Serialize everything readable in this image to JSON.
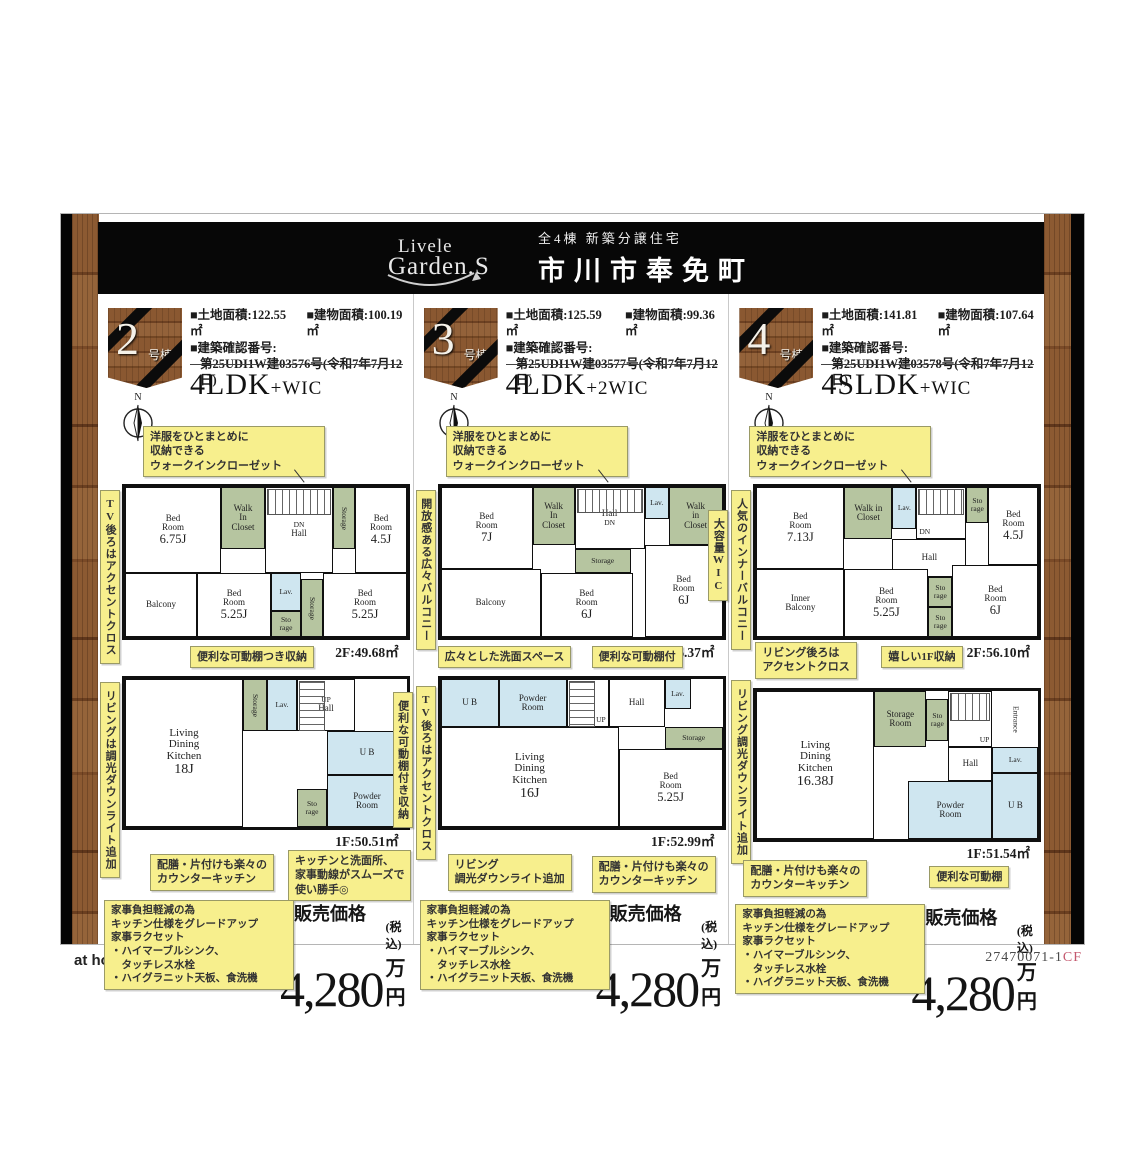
{
  "header": {
    "logo_top": "Livele",
    "logo_bottom": "Garden.S",
    "subtitle": "全4棟 新築分譲住宅",
    "title": "市川市奉免町"
  },
  "compass": {
    "north": "N"
  },
  "footer": {
    "brand": "at home",
    "code": "27470071-1",
    "code_suffix": "CF"
  },
  "panels": [
    {
      "badge": {
        "number": "2",
        "suffix": "号棟"
      },
      "specs": {
        "land": "■土地面積:122.55㎡",
        "building": "■建物面積:100.19㎡",
        "confirm_label": "■建築確認番号:",
        "confirm_value": "第25UDI1W建03576号(令和7年7月12日)"
      },
      "layout_main": "4LDK",
      "layout_sub": "+WIC",
      "notes": {
        "wic": "洋服をひとまとめに\n収納できる\nウォークインクローゼット",
        "left2f": "TV後ろはアクセントクロス",
        "mid": "便利な可動棚つき収納",
        "left1f": "リビングは調光ダウンライト追加",
        "right1f": "便利な可動棚付き収納",
        "bottom1": "配膳・片付けも楽々の\nカウンターキッチン",
        "bottom2": "キッチンと洗面所、\n家事動線がスムーズで\n使い勝手◎"
      },
      "plan2f": {
        "area": "2F:49.68㎡",
        "rooms": {
          "bed1": {
            "label": "Bed\nRoom",
            "size": "6.75J"
          },
          "wic": {
            "label": "Walk\nIn\nCloset"
          },
          "dn": {
            "label": "DN"
          },
          "hall": {
            "label": "Hall"
          },
          "storage1": {
            "label": "Storage"
          },
          "bed2": {
            "label": "Bed\nRoom",
            "size": "4.5J"
          },
          "balcony": {
            "label": "Balcony"
          },
          "bed3": {
            "label": "Bed\nRoom",
            "size": "5.25J"
          },
          "lav": {
            "label": "Lav."
          },
          "sto": {
            "label": "Sto\nrage"
          },
          "storage2": {
            "label": "Storage"
          },
          "bed4": {
            "label": "Bed\nRoom",
            "size": "5.25J"
          }
        }
      },
      "plan1f": {
        "area": "1F:50.51㎡",
        "rooms": {
          "ldk": {
            "label": "Living\nDining\nKitchen",
            "size": "18J"
          },
          "storage": {
            "label": "Storage"
          },
          "lav": {
            "label": "Lav."
          },
          "up": {
            "label": "UP"
          },
          "hall": {
            "label": "Hall"
          },
          "ub": {
            "label": "U B"
          },
          "powder": {
            "label": "Powder\nRoom"
          },
          "sto": {
            "label": "Sto\nrage"
          }
        }
      },
      "price": {
        "features": "家事負担軽減の為\nキッチン仕様をグレードアップ\n家事ラクセット\n・ハイマーブルシンク、\n　タッチレス水栓\n・ハイグラニット天板、食洗機",
        "label": "販売価格",
        "amount": "4,280",
        "tax": "(税込)",
        "unit": "万円"
      }
    },
    {
      "badge": {
        "number": "3",
        "suffix": "号棟"
      },
      "specs": {
        "land": "■土地面積:125.59㎡",
        "building": "■建物面積:99.36㎡",
        "confirm_label": "■建築確認番号:",
        "confirm_value": "第25UDI1W建03577号(令和7年7月12日)"
      },
      "layout_main": "4LDK",
      "layout_sub": "+2WIC",
      "notes": {
        "wic": "洋服をひとまとめに\n収納できる\nウォークインクローゼット",
        "left2f": "開放感ある広々バルコニー",
        "right2f": "大容量WIC",
        "top1f_a": "広々とした洗面スペース",
        "top1f_b": "便利な可動棚付",
        "left1f": "TV後ろはアクセントクロス",
        "bottom1": "リビング\n調光ダウンライト追加",
        "bottom2": "配膳・片付けも楽々の\nカウンターキッチン"
      },
      "plan2f": {
        "area": "2F:46.37㎡",
        "rooms": {
          "bed1": {
            "label": "Bed\nRoom",
            "size": "7J"
          },
          "wic1": {
            "label": "Walk\nIn\nCloset"
          },
          "hall": {
            "label": "Hall"
          },
          "dn": {
            "label": "DN"
          },
          "lav": {
            "label": "Lav."
          },
          "wic2": {
            "label": "Walk\nin\nCloset"
          },
          "storage": {
            "label": "Storage"
          },
          "balcony": {
            "label": "Balcony"
          },
          "bed2": {
            "label": "Bed\nRoom",
            "size": "6J"
          },
          "bed3": {
            "label": "Bed\nRoom",
            "size": "6J"
          }
        }
      },
      "plan1f": {
        "area": "1F:52.99㎡",
        "rooms": {
          "ub": {
            "label": "U B"
          },
          "powder": {
            "label": "Powder\nRoom"
          },
          "up": {
            "label": "UP"
          },
          "hall": {
            "label": "Hall"
          },
          "lav": {
            "label": "Lav."
          },
          "storage": {
            "label": "Storage"
          },
          "ldk": {
            "label": "Living\nDining\nKitchen",
            "size": "16J"
          },
          "bed": {
            "label": "Bed\nRoom",
            "size": "5.25J"
          }
        }
      },
      "price": {
        "features": "家事負担軽減の為\nキッチン仕様をグレードアップ\n家事ラクセット\n・ハイマーブルシンク、\n　タッチレス水栓\n・ハイグラニット天板、食洗機",
        "label": "販売価格",
        "amount": "4,280",
        "tax": "(税込)",
        "unit": "万円"
      }
    },
    {
      "badge": {
        "number": "4",
        "suffix": "号棟"
      },
      "specs": {
        "land": "■土地面積:141.81㎡",
        "building": "■建物面積:107.64㎡",
        "confirm_label": "■建築確認番号:",
        "confirm_value": "第25UDI1W建03578号(令和7年7月12日)"
      },
      "layout_main": "4SLDK",
      "layout_sub": "+WIC",
      "notes": {
        "wic": "洋服をひとまとめに\n収納できる\nウォークインクローゼット",
        "left2f": "人気のインナーバルコニー",
        "top1f_a": "リビング後ろは\nアクセントクロス",
        "top1f_b": "嬉しい1F収納",
        "left1f": "リビング調光ダウンライト追加",
        "bottom1": "配膳・片付けも楽々の\nカウンターキッチン",
        "bottom2": "便利な可動棚"
      },
      "plan2f": {
        "area": "2F:56.10㎡",
        "rooms": {
          "bed1": {
            "label": "Bed\nRoom",
            "size": "7.13J"
          },
          "wic": {
            "label": "Walk in\nCloset"
          },
          "lav": {
            "label": "Lav."
          },
          "dn": {
            "label": "DN"
          },
          "sto1": {
            "label": "Sto\nrage"
          },
          "bed2": {
            "label": "Bed\nRoom",
            "size": "4.5J"
          },
          "hall": {
            "label": "Hall"
          },
          "inner": {
            "label": "Inner\nBalcony"
          },
          "bed3": {
            "label": "Bed\nRoom",
            "size": "5.25J"
          },
          "sto2": {
            "label": "Sto\nrage"
          },
          "sto3": {
            "label": "Sto\nrage"
          },
          "bed4": {
            "label": "Bed\nRoom",
            "size": "6J"
          }
        }
      },
      "plan1f": {
        "area": "1F:51.54㎡",
        "rooms": {
          "stroom": {
            "label": "Storage\nRoom"
          },
          "sto": {
            "label": "Sto\nrage"
          },
          "up": {
            "label": "UP"
          },
          "hall": {
            "label": "Hall"
          },
          "entrance": {
            "label": "Entrance"
          },
          "ldk": {
            "label": "Living\nDining\nKitchen",
            "size": "16.38J"
          },
          "lav": {
            "label": "Lav."
          },
          "powder": {
            "label": "Powder\nRoom"
          },
          "ub": {
            "label": "U B"
          }
        }
      },
      "price": {
        "features": "家事負担軽減の為\nキッチン仕様をグレードアップ\n家事ラクセット\n・ハイマーブルシンク、\n　タッチレス水栓\n・ハイグラニット天板、食洗機",
        "label": "販売価格",
        "amount": "4,280",
        "tax": "(税込)",
        "unit": "万円"
      }
    }
  ]
}
